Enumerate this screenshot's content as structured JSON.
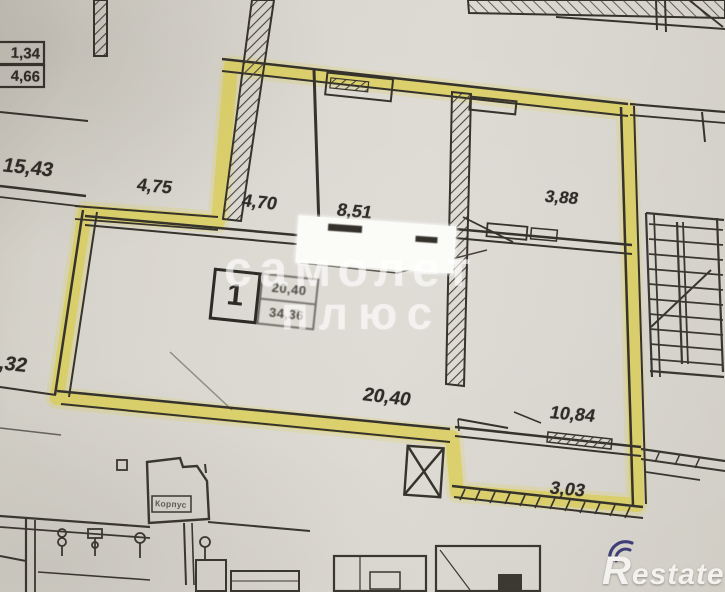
{
  "plan": {
    "dimensions": [
      {
        "id": "dim-top-left-box-1",
        "text": "1,34"
      },
      {
        "id": "dim-top-left-box-2",
        "text": "4,66"
      },
      {
        "id": "dim-15-43",
        "text": "15,43"
      },
      {
        "id": "dim-4-75",
        "text": "4,75"
      },
      {
        "id": "dim-4-70",
        "text": "4,70"
      },
      {
        "id": "dim-8-51",
        "text": "8,51"
      },
      {
        "id": "dim-3-88",
        "text": "3,88"
      },
      {
        "id": "dim-0-32",
        "text": "0,32"
      },
      {
        "id": "dim-20-40",
        "text": "20,40"
      },
      {
        "id": "dim-10-84",
        "text": "10,84"
      },
      {
        "id": "dim-3-03",
        "text": "3,03"
      }
    ],
    "unit_label": {
      "number": "1",
      "area_line1": "20,40",
      "area_line2": "34,36"
    },
    "small_box_label": "Корпус"
  },
  "watermark": {
    "line1": "самолет",
    "line2": "плюс"
  },
  "logo": {
    "text": "Restate"
  },
  "colors": {
    "paper": "#d7d4cd",
    "ink": "#36332d",
    "highlight": "#dccd2a",
    "watermark": "#ffffff",
    "logo_accent": "#3d3d78"
  }
}
